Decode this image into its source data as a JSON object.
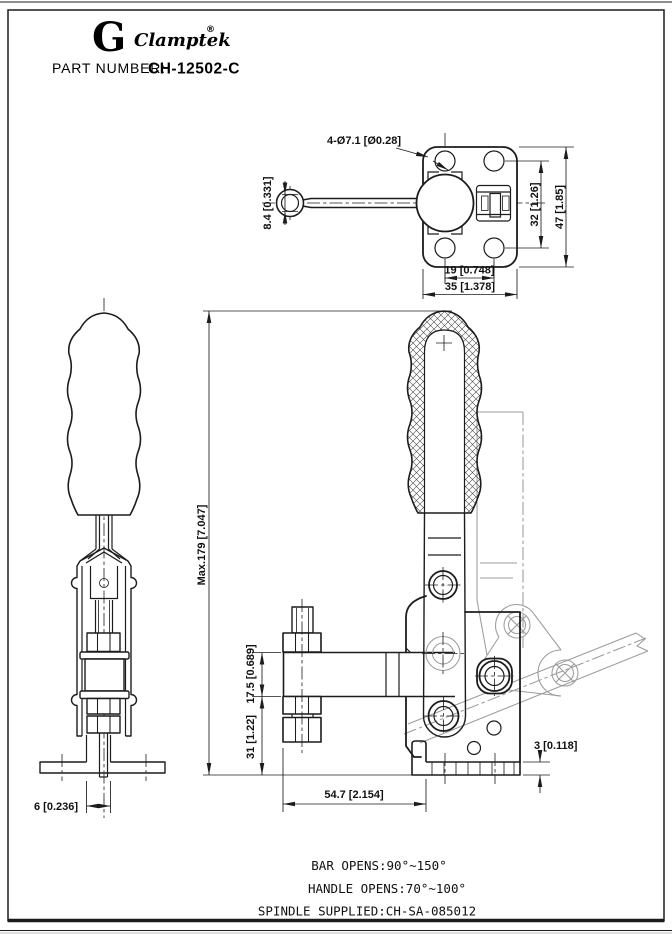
{
  "colors": {
    "ink": "#1c1c1c",
    "phantom": "#9b9b9b",
    "background": "#ffffff"
  },
  "header": {
    "logo_glyph": "G",
    "brand": "Clamptek",
    "registered": "®",
    "part_label": "PART NUMBER:",
    "part_number": "CH-12502-C"
  },
  "top_view": {
    "holes_callout": "4-Ø7.1 [Ø0.28]",
    "ring_dim": "8.4 [0.331]",
    "hole_spacing_v": "32 [1.26]",
    "plate_height": "47 [1.85]",
    "hole_spacing_h": "19 [0.748]",
    "plate_width": "35 [1.378]"
  },
  "front_view": {
    "spindle_dim": "6 [0.236]"
  },
  "side_view": {
    "max_height": "Max.179 [7.047]",
    "bar_section": "17.5 [0.689]",
    "bar_to_base": "31 [1.22]",
    "bar_length": "54.7 [2.154]",
    "base_thickness": "3 [0.118]"
  },
  "notes": {
    "bar_opens": "BAR OPENS:90°~150°",
    "handle_opens": "HANDLE OPENS:70°~100°",
    "spindle_supplied": "SPINDLE SUPPLIED:CH-SA-085012"
  }
}
